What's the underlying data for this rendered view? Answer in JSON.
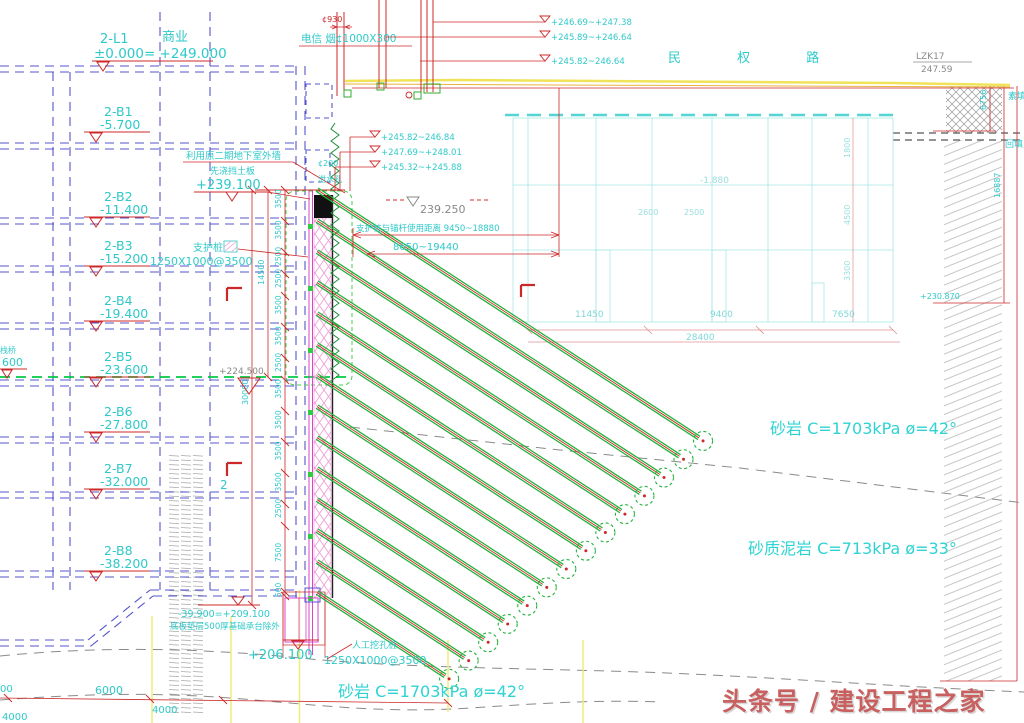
{
  "road": {
    "name": "民  权  路",
    "survey_id": "LZK17",
    "survey_elev": "247.59"
  },
  "left_building": {
    "top": {
      "grid": "2-L1",
      "use": "商业",
      "level": "±0.000= +249.000"
    },
    "floors": [
      {
        "grid": "2-B1",
        "level": "-5.700"
      },
      {
        "grid": "2-B2",
        "level": "-11.400"
      },
      {
        "grid": "2-B3",
        "level": "-15.200"
      },
      {
        "grid": "2-B4",
        "level": "-19.400"
      },
      {
        "grid": "2-B5",
        "level": "-23.600"
      },
      {
        "grid": "2-B6",
        "level": "-27.800"
      },
      {
        "grid": "2-B7",
        "level": "-32.000"
      },
      {
        "grid": "2-B8",
        "level": "-38.200"
      }
    ],
    "platform_note": "栈桥",
    "platform_value": "600",
    "excav_level": "+224.500"
  },
  "wall": {
    "reuse_note": "利用原二期地下室外墙",
    "board_note": "先浇挡土板",
    "board_level": "+239.100",
    "crown_level": "239.250",
    "weep_dia": "¢200",
    "weep_label": "泄水孔",
    "pile_label": "支护桩",
    "pile_size": "1250X1000@3500",
    "dist_note": "支护桩与锚杆使用距离 9450~18880",
    "dist_range": "8650~19440",
    "dim_14500": "14500",
    "dim_30000": "30000",
    "segs": [
      "3500",
      "3500",
      "2500",
      "2500",
      "3500",
      "3500",
      "2500",
      "3500",
      "3500",
      "3500",
      "3500",
      "2500",
      "7500",
      "500"
    ]
  },
  "pipes": {
    "label": "电信 烟¢1000X300",
    "dia": "¢930",
    "levels_upper": [
      "+246.69~+247.38",
      "+245.89~+246.64",
      "+245.82~246.64"
    ],
    "levels_lower": [
      "+245.82~246.84",
      "+247.69~+248.01",
      "+245.32~+245.88"
    ]
  },
  "building": {
    "level": "-1.880",
    "dim_a": "2600",
    "dim_b": "2500",
    "right_dims": [
      "1800",
      "4500",
      "3300"
    ],
    "bottom_dims": [
      "11450",
      "9400",
      "7650"
    ],
    "total": "28400",
    "toe_level": "+230.870"
  },
  "fill": {
    "top_label": "素填土",
    "label": "回填土",
    "depth1": "6756",
    "depth2": "16887"
  },
  "soil": {
    "sandstone": "砂岩  C=1703kPa ø=42°",
    "mudstone": "砂质泥岩  C=713kPa ø=33°",
    "sandstone2": "砂岩  C=1703kPa ø=42°"
  },
  "base": {
    "slab_level": "-39.900=+209.100",
    "slab_note": "底板垫层500厚基础承台除外",
    "pile_toe": "+206.100",
    "pile_label": "人工挖孔桩",
    "pile_size": "1250X1000@3500",
    "dim_6000": "6000",
    "dim_4000": "4000",
    "dim_cut": "00",
    "corner": "4000"
  },
  "marks": {
    "section2": "2"
  },
  "watermark": "头条号 / 建设工程之家",
  "colors": {
    "cyan": "#2fc9c9",
    "blue": "#5555cc",
    "red": "#cc2828",
    "green": "#22b33b",
    "magenta": "#d944c8",
    "yellow": "#efe05a",
    "gray": "#8a8a8a",
    "pink": "#ef9ad4",
    "faint": "#9adede",
    "watermark": "#c96060"
  }
}
